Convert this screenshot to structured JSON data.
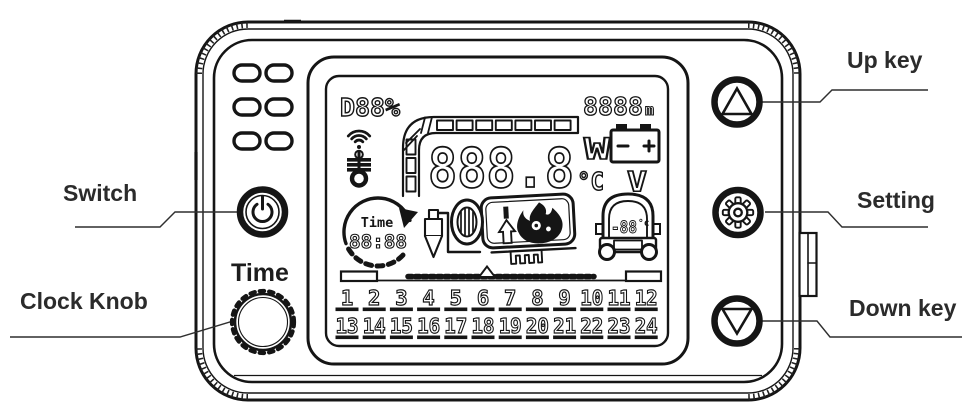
{
  "labels": {
    "switch": "Switch",
    "clock_knob": "Clock Knob",
    "up_key": "Up key",
    "setting": "Setting",
    "down_key": "Down key"
  },
  "knob": {
    "label": "Time"
  },
  "display": {
    "duty_percent": "D88%",
    "altitude_value": "8888",
    "altitude_unit": "m",
    "main_value": "888.8",
    "power_unit": "W",
    "temp_unit": "°C",
    "volt_unit": "V",
    "timer_title": "Time",
    "timer_clock": "88:88",
    "cabin_temp": "-88",
    "cabin_temp_unit": "°c",
    "timer_row1": [
      "1",
      "2",
      "3",
      "4",
      "5",
      "6",
      "7",
      "8",
      "9",
      "10",
      "11",
      "12"
    ],
    "timer_row2": [
      "13",
      "14",
      "15",
      "16",
      "17",
      "18",
      "19",
      "20",
      "21",
      "22",
      "23",
      "24"
    ]
  },
  "icons": {
    "power": "power-symbol",
    "gear": "settings-gear",
    "up_arrow": "triangle-up",
    "down_arrow": "triangle-down",
    "wifi": "wifi-signal",
    "glow_plug": "glow-plug",
    "battery": "battery-terminals",
    "timer_dial": "circular-arrow-clock",
    "fuel_injector": "fuel-injector",
    "heater_flame": "burner-flame",
    "car": "vehicle-front",
    "bar_gauge": "l-shaped-segment-gauge",
    "vents": "speaker-holes"
  },
  "colors": {
    "line": "#151515",
    "label_text": "#2b2b2b",
    "background": "#ffffff"
  }
}
